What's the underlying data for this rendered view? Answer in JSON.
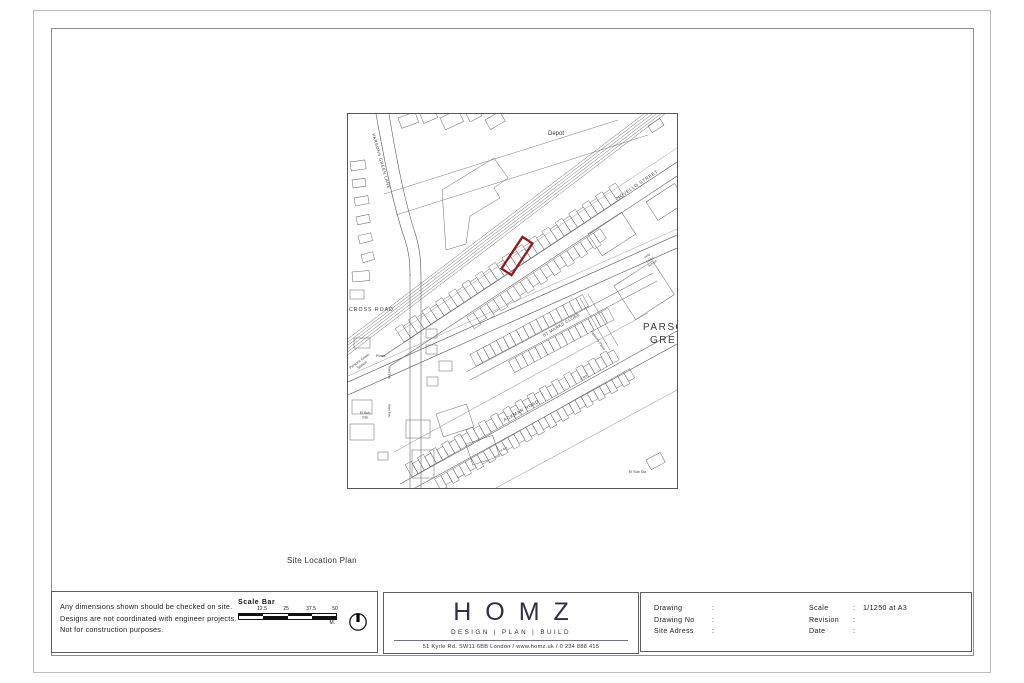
{
  "page": {
    "caption": "Site Location Plan"
  },
  "notes": {
    "line1": "Any dimensions shown should be checked on site.",
    "line2": "Designs are not coordinated with engineer projects.",
    "line3": "Not for construction purposes."
  },
  "scale_bar": {
    "title": "Scale Bar",
    "tick1": "12.5",
    "tick2": "25",
    "tick3": "37.5",
    "tick4": "50",
    "unit": "M."
  },
  "logo": {
    "wordmark": "HOMZ",
    "tagline": "DESIGN | PLAN | BUILD",
    "contact": "51 Kyrle Rd. SW11 6BB London / www.homz.uk / 0 234 888 415",
    "brand_color": "#2f2f45"
  },
  "title_block": {
    "colon": ":",
    "drawing_label": "Drawing",
    "drawing_value": "",
    "drawing_no_label": "Drawing No",
    "drawing_no_value": "",
    "site_address_label": "Site Adress",
    "site_address_value": "",
    "scale_label": "Scale",
    "scale_value": "1/1250 at A3",
    "revision_label": "Revision",
    "revision_value": "",
    "date_label": "Date",
    "date_value": ""
  },
  "map": {
    "site_color": "#8c1d1d",
    "labels": {
      "depot": "Depot",
      "novello_street": "NOVELLO STREET",
      "parsons_green_lane": "PARSONS GREEN LANE",
      "cross_road": "CROSS ROAD",
      "posts": "Posts",
      "st_marks_close": "ST MARKS CLOSE",
      "palmers_place": "Palmers Place",
      "ackmar_road": "ACKMAR ROAD",
      "parsons_green_line1": "PARSONS",
      "parsons_green_line2": "GREEN",
      "school_line1": "Holy",
      "school_line2": "Cross",
      "school_line3": "School",
      "station_line1": "Parsons Green",
      "station_line2": "Station",
      "el_sub_sta_line1": "El Sub",
      "el_sub_sta_line2": "Sta",
      "el_sub_sta": "El Sub Sta",
      "ward_bdy": "Ward Bdy",
      "spot_height_a": "4.9m",
      "spot_height_b": "4.4m"
    }
  }
}
